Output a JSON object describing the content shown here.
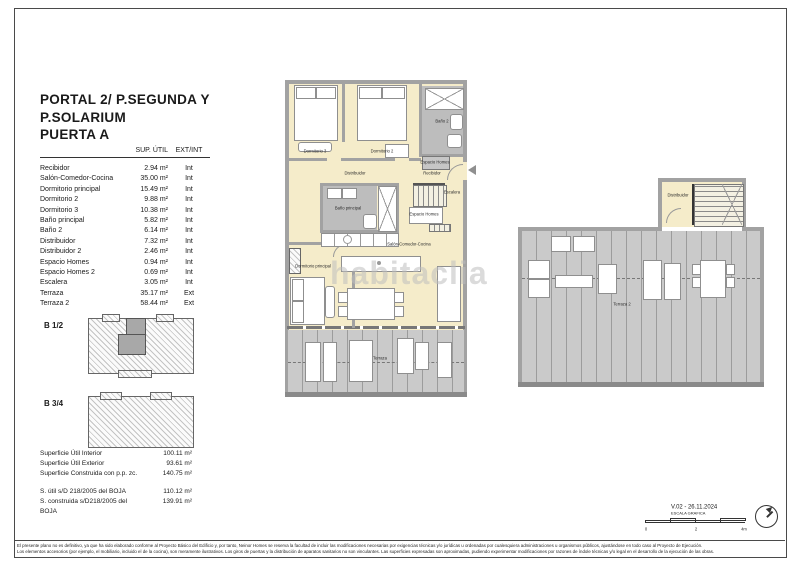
{
  "sheet": {
    "title_lines": [
      "PORTAL 2/ P.SEGUNDA Y",
      "P.SOLARIUM",
      "PUERTA A"
    ],
    "watermark": "habitaclia"
  },
  "area_table": {
    "headers": {
      "sup": "SUP. ÚTIL",
      "extint": "EXT/INT"
    },
    "rows": [
      {
        "name": "Recibidor",
        "area": "2.94 m²",
        "loc": "Int"
      },
      {
        "name": "Salón-Comedor-Cocina",
        "area": "35.00 m²",
        "loc": "Int"
      },
      {
        "name": "Dormitorio principal",
        "area": "15.49 m²",
        "loc": "Int"
      },
      {
        "name": "Dormitorio 2",
        "area": "9.88 m²",
        "loc": "Int"
      },
      {
        "name": "Dormitorio 3",
        "area": "10.38 m²",
        "loc": "Int"
      },
      {
        "name": "Baño principal",
        "area": "5.82 m²",
        "loc": "Int"
      },
      {
        "name": "Baño 2",
        "area": "6.14 m²",
        "loc": "Int"
      },
      {
        "name": "Distribuidor",
        "area": "7.32 m²",
        "loc": "Int"
      },
      {
        "name": "Distribuidor 2",
        "area": "2.46 m²",
        "loc": "Int"
      },
      {
        "name": "Espacio Homes",
        "area": "0.94 m²",
        "loc": "Int"
      },
      {
        "name": "Espacio Homes 2",
        "area": "0.69 m²",
        "loc": "Int"
      },
      {
        "name": "Escalera",
        "area": "3.05 m²",
        "loc": "Int"
      },
      {
        "name": "Terraza",
        "area": "35.17 m²",
        "loc": "Ext"
      },
      {
        "name": "Terraza 2",
        "area": "58.44 m²",
        "loc": "Ext"
      }
    ]
  },
  "key_plans": {
    "b12": "B 1/2",
    "b34": "B 3/4"
  },
  "summary": {
    "rows": [
      {
        "name": "Superficie Útil Interior",
        "value": "100.11 m²"
      },
      {
        "name": "Superficie Útil Exterior",
        "value": "93.61 m²"
      },
      {
        "name": "Superficie Construida con p.p. zc.",
        "value": "140.75 m²"
      }
    ],
    "boja_rows": [
      {
        "name": "S. útil s/D 218/2005 del BOJA",
        "value": "110.12 m²"
      },
      {
        "name": "S. construida s/D218/2005 del BOJA",
        "value": "139.91 m²"
      }
    ]
  },
  "plans": {
    "main": {
      "labels": {
        "dormitorio3": "Dormitorio 3",
        "dormitorio2": "Dormitorio 2",
        "bano2": "Baño 2",
        "espacio_homes": "Espacio Homes",
        "distribuidor": "Distribuidor",
        "recibidor": "Recibidor",
        "bano_principal": "Baño principal",
        "escalera": "Escalera",
        "espacio_homes2": "Espacio Homes",
        "salon": "Salón-Comedor-Cocina",
        "dormitorio_principal": "Dormitorio principal",
        "terraza": "Terraza"
      }
    },
    "solarium": {
      "labels": {
        "distribuidor": "Distribuidor",
        "terraza2": "Terraza 2"
      }
    }
  },
  "revision": {
    "version": "V.02 - 26.11.2024",
    "scale_label": "ESCALA GRAFICA",
    "ticks": [
      "0",
      "2",
      "4m"
    ]
  },
  "footer": {
    "line1": "El presente plano no es definitivo, ya que ha sido elaborado conforme al Proyecto Básico del Edificio y, por tanto, Neinor Homes se reserva la facultad de incluir las modificaciones necesarias por exigencias técnicas y/o jurídicas u ordenadas por cualesquiera administraciones u organismos públicos, ajustándose en todo caso al Proyecto de Ejecución.",
    "line2": "Los elementos accesorios (por ejemplo, el mobiliario, incluido el de la cocina), son meramente ilustrativos. Los giros de puertas y la distribución de aparatos sanitarios no son vinculantes. Las superficies expresadas son aproximadas, pudiendo experimentar modificaciones por razones de índole técnicas y/o legal en el desarrollo de la ejecución de las obras."
  },
  "colors": {
    "floor": "#f5ecca",
    "bath_floor": "#bdbdbd",
    "terrace_floor": "#cacaca",
    "wall": "#a2a2a2"
  }
}
